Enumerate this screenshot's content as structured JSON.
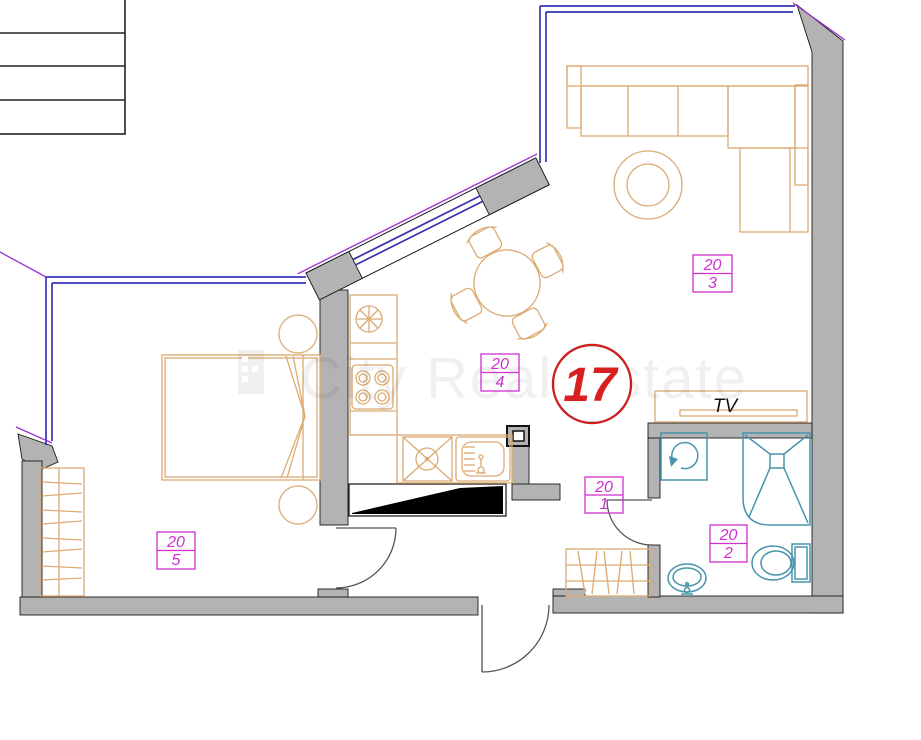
{
  "plan": {
    "apartment_number": "17",
    "tv_label": "TV",
    "watermark": "City Real Estate",
    "unit_labels": [
      {
        "building": "20",
        "unit": "3"
      },
      {
        "building": "20",
        "unit": "4"
      },
      {
        "building": "20",
        "unit": "5"
      },
      {
        "building": "20",
        "unit": "1"
      },
      {
        "building": "20",
        "unit": "2"
      }
    ],
    "colors": {
      "wall_fill": "#b3b3b3",
      "wall_outline": "#1a1a1a",
      "furniture_tan": "#dcab72",
      "fixture_teal": "#4695ac",
      "label_magenta": "#cf2fcf",
      "window_blue": "#3434b4",
      "accent_purple": "#9a30d0",
      "apartment_red": "#d82020",
      "shaft_black": "#000000"
    }
  }
}
